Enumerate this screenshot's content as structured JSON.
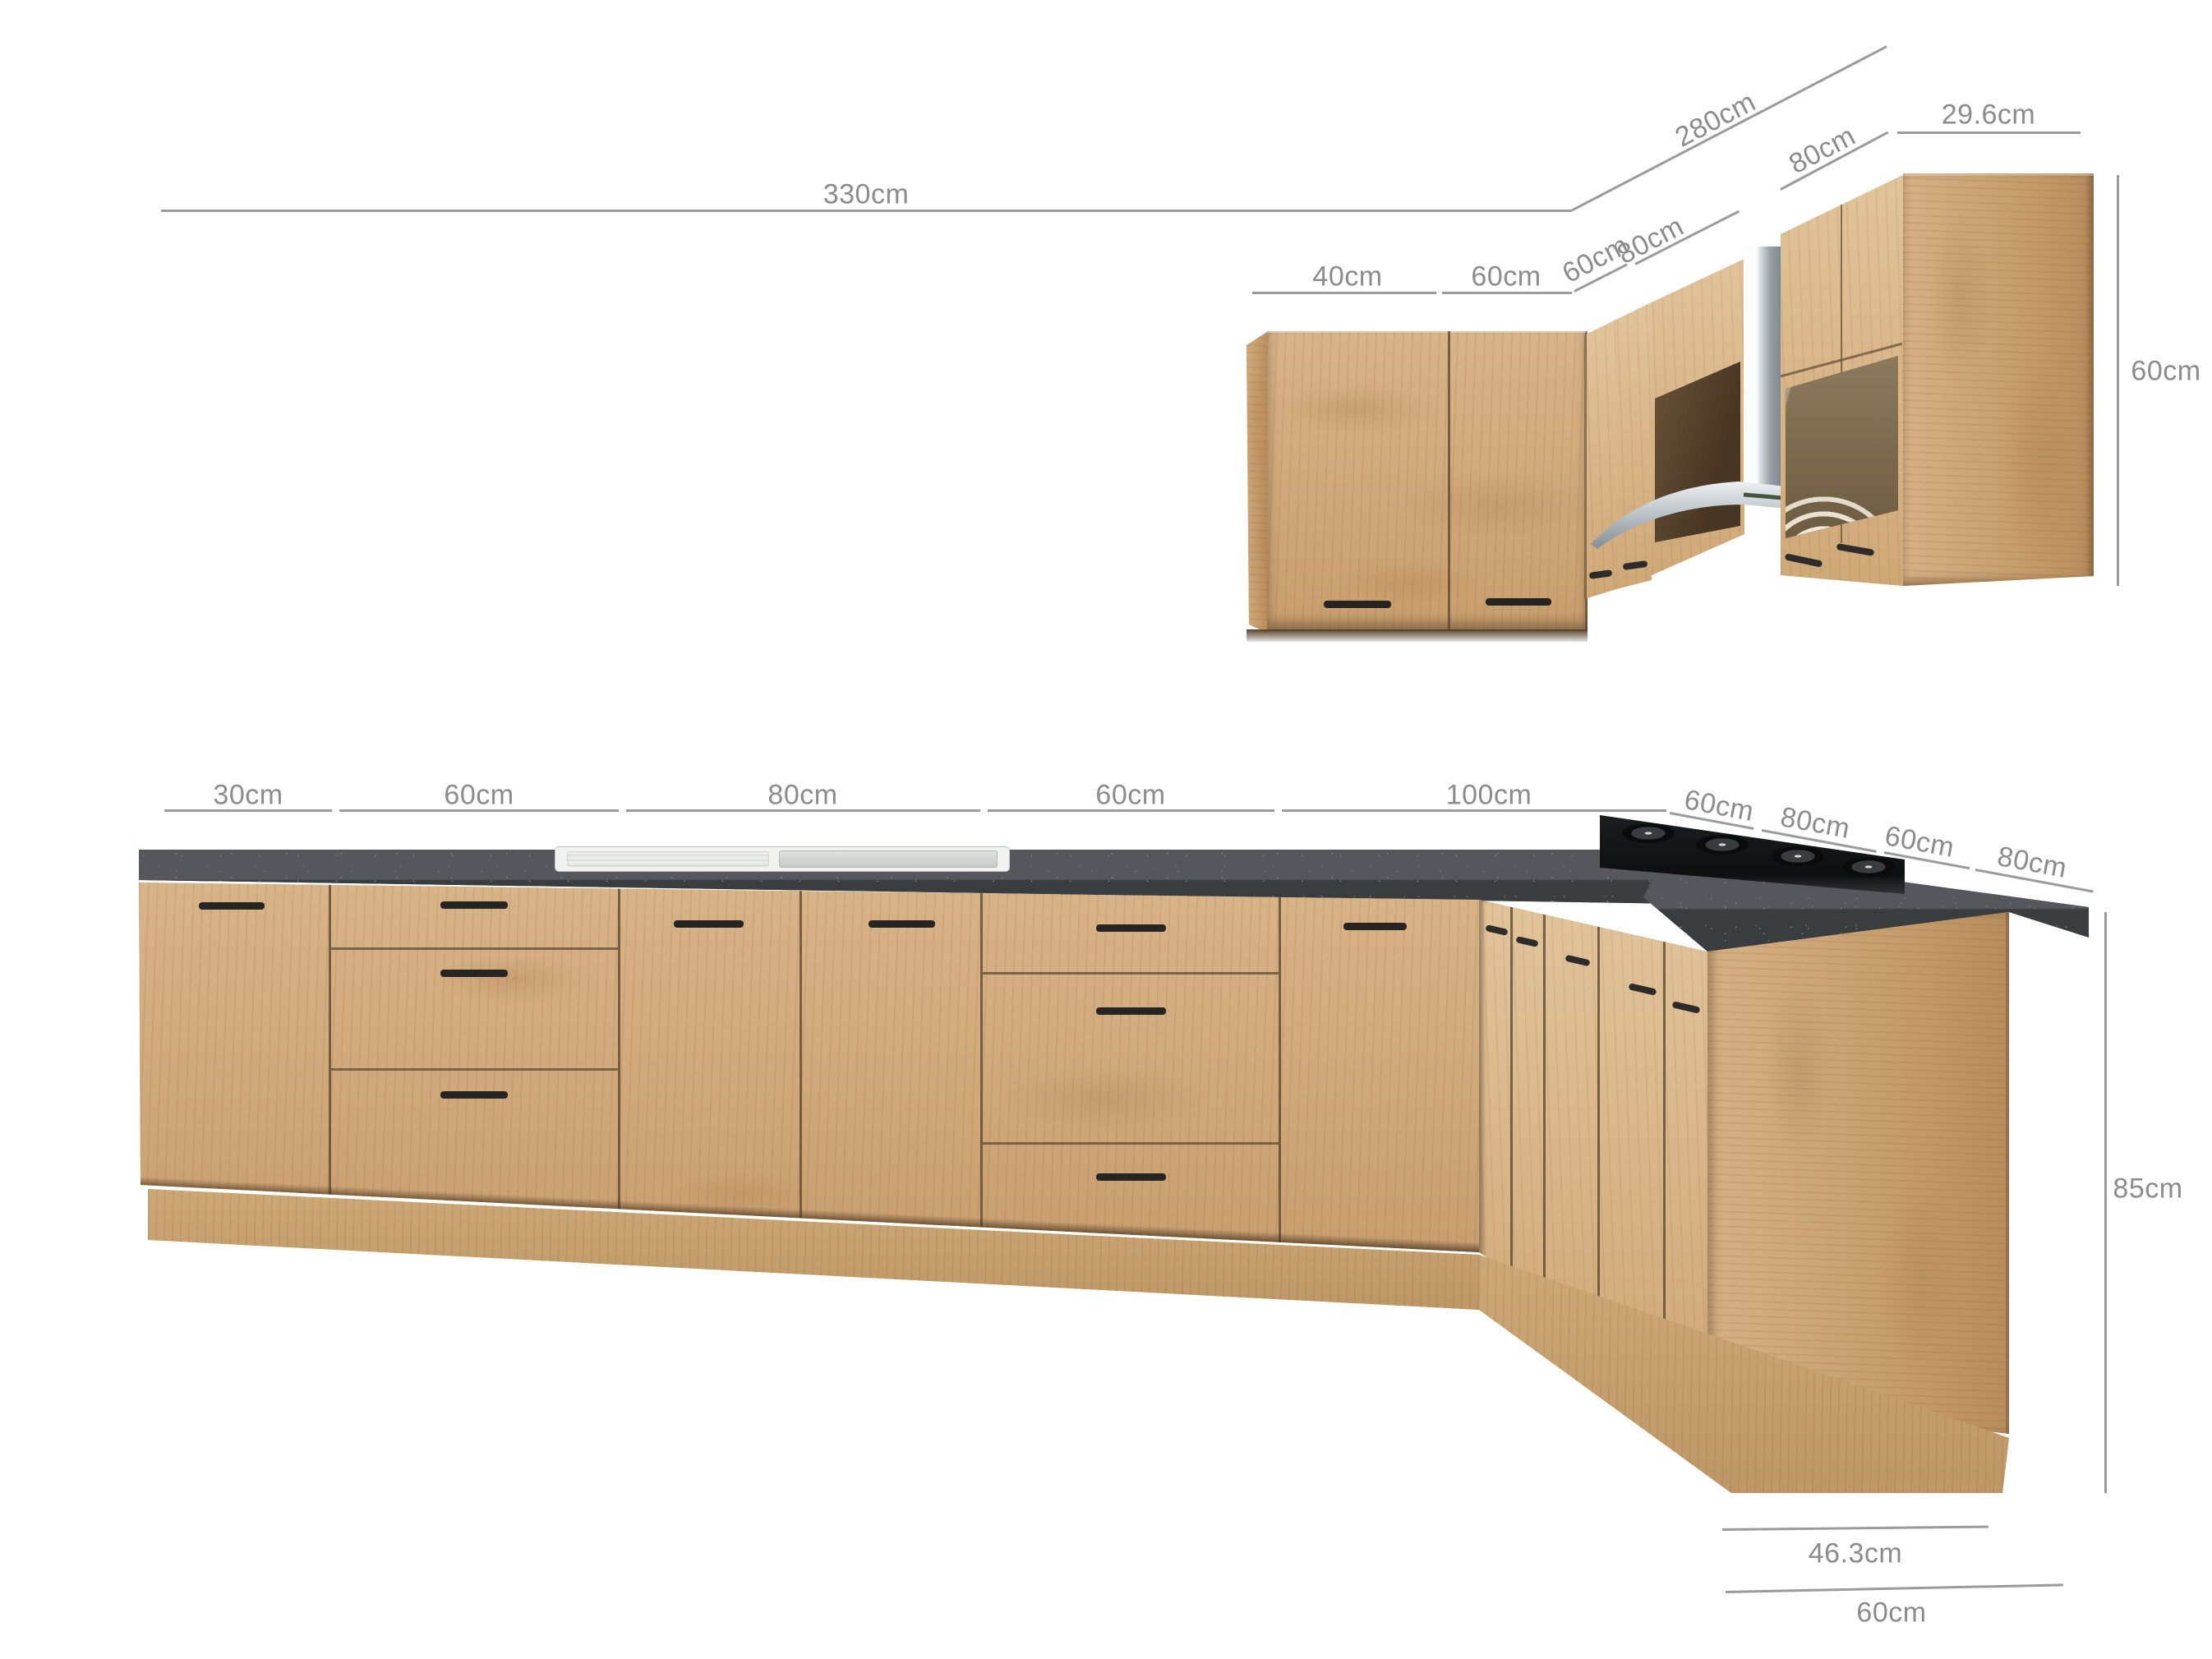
{
  "diagram": {
    "kind": "kitchen-furniture-dimension-diagram",
    "units": "cm",
    "colors": {
      "wood": "#d0a87b",
      "countertop": "#45484b",
      "dimension_gray": "#9b9b9b"
    },
    "wall_run": {
      "total": "330cm",
      "side_total": "280cm",
      "end_depth": "29.6cm",
      "hood_width": "80cm",
      "front_segments": [
        "40cm",
        "60cm"
      ],
      "corner_segments": [
        "60cm",
        "80cm"
      ],
      "height": "60cm"
    },
    "base_run": {
      "front_segments": [
        "30cm",
        "60cm",
        "80cm",
        "60cm",
        "100cm"
      ],
      "side_segments": [
        "60cm",
        "80cm",
        "60cm",
        "80cm"
      ],
      "height": "85cm",
      "end_depth": "46.3cm",
      "end_width": "60cm"
    }
  }
}
